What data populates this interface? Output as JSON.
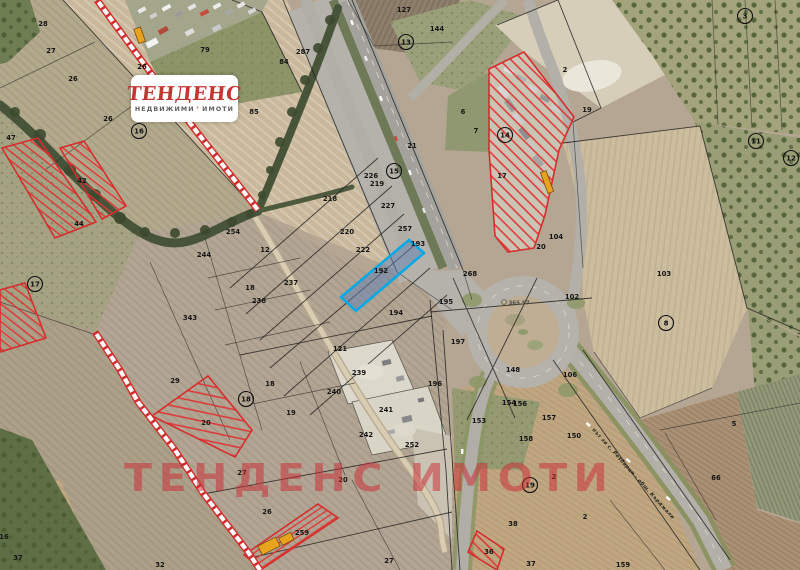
{
  "page": {
    "width": 800,
    "height": 570,
    "description_visible_type": "cadastral satellite map"
  },
  "logo": {
    "title": "ТЕНДЕНС",
    "subtitle_word1": "НЕДВИЖИМИ",
    "accent": "’",
    "subtitle_word2": "ИМОТИ",
    "title_color": "#c13732",
    "subtitle_color": "#5e5e5e"
  },
  "watermark": {
    "text": "ТЕНДЕНС ИМОТИ",
    "color": "rgba(203,44,54,0.52)"
  },
  "highlight": {
    "parcel_id": "192",
    "stroke_color": "#00a9e8",
    "fill_color": "rgba(98,130,180,0.5)",
    "label_color": "#5c443a"
  },
  "road_label": {
    "text": "път за с. Резбарци - общ. Кърджали"
  },
  "survey_point_label": {
    "text": "365 57"
  },
  "hatch_color": "#e03333",
  "boundary_color": "#d62d2d",
  "ladder_color": "#d03030",
  "cadastral_line_color": "#1c1c1c",
  "label_color": "#141414",
  "parcel_labels": [
    {
      "t": "28",
      "x": 43,
      "y": 24
    },
    {
      "t": "27",
      "x": 51,
      "y": 51
    },
    {
      "t": "26",
      "x": 73,
      "y": 79
    },
    {
      "t": "26",
      "x": 108,
      "y": 119
    },
    {
      "t": "26",
      "x": 142,
      "y": 67
    },
    {
      "t": "47",
      "x": 11,
      "y": 138
    },
    {
      "t": "42",
      "x": 82,
      "y": 181
    },
    {
      "t": "44",
      "x": 79,
      "y": 224
    },
    {
      "t": "79",
      "x": 205,
      "y": 50
    },
    {
      "t": "287",
      "x": 303,
      "y": 52
    },
    {
      "t": "127",
      "x": 404,
      "y": 10
    },
    {
      "t": "144",
      "x": 437,
      "y": 29
    },
    {
      "t": "84",
      "x": 284,
      "y": 62
    },
    {
      "t": "85",
      "x": 254,
      "y": 112
    },
    {
      "t": "2",
      "x": 565,
      "y": 70
    },
    {
      "t": "19",
      "x": 587,
      "y": 110
    },
    {
      "t": "6",
      "x": 463,
      "y": 112
    },
    {
      "t": "7",
      "x": 476,
      "y": 131
    },
    {
      "t": "17",
      "x": 502,
      "y": 176
    },
    {
      "t": "21",
      "x": 412,
      "y": 146
    },
    {
      "t": "226",
      "x": 371,
      "y": 176
    },
    {
      "t": "219",
      "x": 377,
      "y": 184
    },
    {
      "t": "227",
      "x": 388,
      "y": 206
    },
    {
      "t": "257",
      "x": 405,
      "y": 229
    },
    {
      "t": "193",
      "x": 418,
      "y": 244
    },
    {
      "t": "268",
      "x": 470,
      "y": 274
    },
    {
      "t": "218",
      "x": 330,
      "y": 199
    },
    {
      "t": "220",
      "x": 347,
      "y": 232
    },
    {
      "t": "222",
      "x": 363,
      "y": 250
    },
    {
      "t": "194",
      "x": 396,
      "y": 313
    },
    {
      "t": "195",
      "x": 446,
      "y": 302
    },
    {
      "t": "254",
      "x": 233,
      "y": 232
    },
    {
      "t": "12",
      "x": 265,
      "y": 250
    },
    {
      "t": "244",
      "x": 204,
      "y": 255
    },
    {
      "t": "237",
      "x": 291,
      "y": 283
    },
    {
      "t": "18",
      "x": 250,
      "y": 288
    },
    {
      "t": "238",
      "x": 259,
      "y": 301
    },
    {
      "t": "343",
      "x": 190,
      "y": 318
    },
    {
      "t": "121",
      "x": 340,
      "y": 349
    },
    {
      "t": "239",
      "x": 359,
      "y": 373
    },
    {
      "t": "240",
      "x": 334,
      "y": 392
    },
    {
      "t": "241",
      "x": 386,
      "y": 410
    },
    {
      "t": "242",
      "x": 366,
      "y": 435
    },
    {
      "t": "252",
      "x": 412,
      "y": 445
    },
    {
      "t": "104",
      "x": 556,
      "y": 237
    },
    {
      "t": "20",
      "x": 541,
      "y": 247
    },
    {
      "t": "102",
      "x": 572,
      "y": 297
    },
    {
      "t": "103",
      "x": 664,
      "y": 274
    },
    {
      "t": "197",
      "x": 458,
      "y": 342
    },
    {
      "t": "148",
      "x": 513,
      "y": 370
    },
    {
      "t": "106",
      "x": 570,
      "y": 375
    },
    {
      "t": "196",
      "x": 435,
      "y": 384
    },
    {
      "t": "154",
      "x": 509,
      "y": 403
    },
    {
      "t": "156",
      "x": 520,
      "y": 404
    },
    {
      "t": "153",
      "x": 479,
      "y": 421
    },
    {
      "t": "157",
      "x": 549,
      "y": 418
    },
    {
      "t": "158",
      "x": 526,
      "y": 439
    },
    {
      "t": "150",
      "x": 574,
      "y": 436
    },
    {
      "t": "2",
      "x": 554,
      "y": 477
    },
    {
      "t": "38",
      "x": 513,
      "y": 524
    },
    {
      "t": "37",
      "x": 531,
      "y": 564
    },
    {
      "t": "36",
      "x": 489,
      "y": 552
    },
    {
      "t": "18",
      "x": 270,
      "y": 384
    },
    {
      "t": "19",
      "x": 291,
      "y": 413
    },
    {
      "t": "29",
      "x": 175,
      "y": 381
    },
    {
      "t": "20",
      "x": 206,
      "y": 423
    },
    {
      "t": "27",
      "x": 242,
      "y": 473
    },
    {
      "t": "20",
      "x": 343,
      "y": 480
    },
    {
      "t": "26",
      "x": 267,
      "y": 512
    },
    {
      "t": "259",
      "x": 302,
      "y": 533
    },
    {
      "t": "27",
      "x": 389,
      "y": 561
    },
    {
      "t": "37",
      "x": 18,
      "y": 558
    },
    {
      "t": "32",
      "x": 160,
      "y": 565
    },
    {
      "t": "16",
      "x": 4,
      "y": 537
    },
    {
      "t": "5",
      "x": 734,
      "y": 424
    },
    {
      "t": "66",
      "x": 716,
      "y": 478
    },
    {
      "t": "2",
      "x": 585,
      "y": 517
    },
    {
      "t": "159",
      "x": 623,
      "y": 565
    },
    {
      "t": "192",
      "x": 381,
      "y": 271,
      "c": "#5c443a"
    }
  ],
  "circle_labels": [
    {
      "t": "16",
      "x": 139,
      "y": 131
    },
    {
      "t": "17",
      "x": 35,
      "y": 284
    },
    {
      "t": "13",
      "x": 406,
      "y": 42
    },
    {
      "t": "15",
      "x": 394,
      "y": 171
    },
    {
      "t": "14",
      "x": 505,
      "y": 135
    },
    {
      "t": "8",
      "x": 666,
      "y": 323
    },
    {
      "t": "18",
      "x": 246,
      "y": 399
    },
    {
      "t": "19",
      "x": 530,
      "y": 485
    },
    {
      "t": "3",
      "x": 745,
      "y": 16
    },
    {
      "t": "11",
      "x": 756,
      "y": 141
    },
    {
      "t": "12",
      "x": 791,
      "y": 158
    }
  ]
}
